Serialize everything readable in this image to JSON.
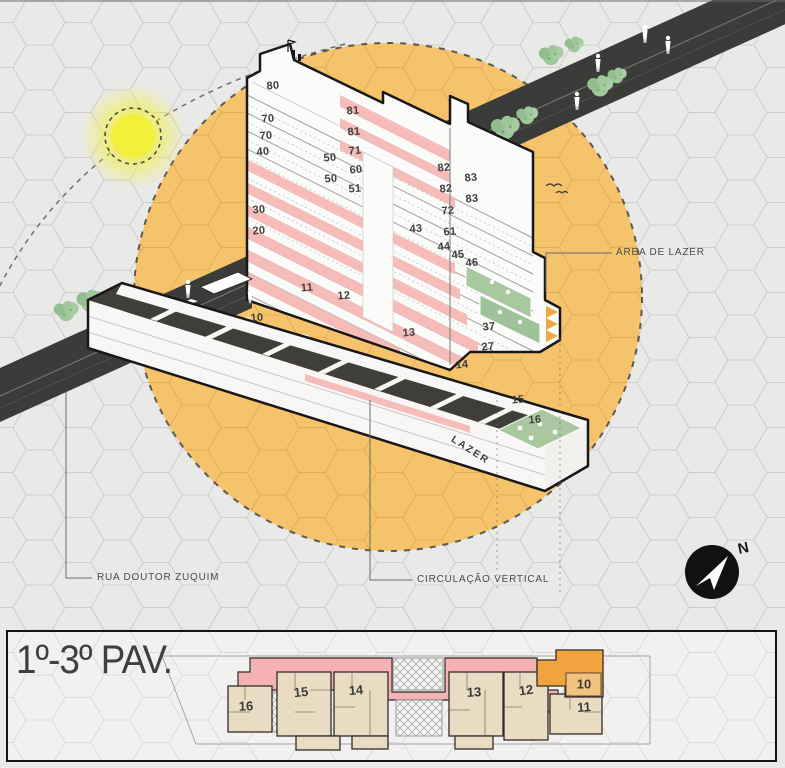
{
  "colors": {
    "circle_orange": "#f5c36c",
    "sun_yellow": "#f1ef39",
    "balcony_pink": "#f5bcba",
    "road_dark": "#3b3b39",
    "leisure_green": "#a9c8a0",
    "plan_beige": "#eadcc3",
    "highlight_unit": "#f1a43e",
    "ink": "#3e3e3c"
  },
  "annotations": {
    "area_lazer": "ÁREA DE LAZER",
    "rua": "RUA DOUTOR ZUQUIM",
    "circulacao": "CIRCULAÇÃO VERTICAL",
    "lazer_text": "LAZER",
    "north": "N"
  },
  "panel": {
    "floor_label": "1º-3º PAV."
  },
  "icons": {
    "sun": "sun-glow-disc",
    "north_arrow": "compass-needle-circle",
    "tree": "street-tree-cluster",
    "person": "pedestrian-silhouette"
  },
  "axon_units": [
    {
      "label": "80",
      "x": 273,
      "y": 86,
      "rot": -5
    },
    {
      "label": "70",
      "x": 268,
      "y": 119,
      "rot": -5
    },
    {
      "label": "70",
      "x": 266,
      "y": 136,
      "rot": -5
    },
    {
      "label": "40",
      "x": 263,
      "y": 152,
      "rot": -5
    },
    {
      "label": "30",
      "x": 259,
      "y": 210,
      "rot": -5
    },
    {
      "label": "20",
      "x": 259,
      "y": 231,
      "rot": -5
    },
    {
      "label": "81",
      "x": 353,
      "y": 111,
      "rot": -5
    },
    {
      "label": "81",
      "x": 354,
      "y": 132,
      "rot": -5
    },
    {
      "label": "71",
      "x": 355,
      "y": 151,
      "rot": -5
    },
    {
      "label": "50",
      "x": 330,
      "y": 158,
      "rot": -5
    },
    {
      "label": "60",
      "x": 356,
      "y": 170,
      "rot": -5
    },
    {
      "label": "50",
      "x": 331,
      "y": 179,
      "rot": -5
    },
    {
      "label": "51",
      "x": 355,
      "y": 189,
      "rot": -5
    },
    {
      "label": "82",
      "x": 444,
      "y": 168,
      "rot": -5
    },
    {
      "label": "83",
      "x": 471,
      "y": 178,
      "rot": -5
    },
    {
      "label": "82",
      "x": 446,
      "y": 189,
      "rot": -5
    },
    {
      "label": "83",
      "x": 472,
      "y": 199,
      "rot": -5
    },
    {
      "label": "72",
      "x": 448,
      "y": 211,
      "rot": -5
    },
    {
      "label": "61",
      "x": 450,
      "y": 232,
      "rot": -5
    },
    {
      "label": "43",
      "x": 416,
      "y": 229,
      "rot": -5
    },
    {
      "label": "44",
      "x": 444,
      "y": 247,
      "rot": -5
    },
    {
      "label": "45",
      "x": 458,
      "y": 255,
      "rot": -5
    },
    {
      "label": "46",
      "x": 472,
      "y": 263,
      "rot": -5
    },
    {
      "label": "37",
      "x": 489,
      "y": 327,
      "rot": -5
    },
    {
      "label": "27",
      "x": 488,
      "y": 347,
      "rot": -5
    },
    {
      "label": "10",
      "x": 257,
      "y": 318,
      "rot": -5
    },
    {
      "label": "11",
      "x": 307,
      "y": 288,
      "rot": -5
    },
    {
      "label": "12",
      "x": 344,
      "y": 296,
      "rot": -5
    },
    {
      "label": "13",
      "x": 409,
      "y": 333,
      "rot": -5
    },
    {
      "label": "14",
      "x": 462,
      "y": 365,
      "rot": -5
    },
    {
      "label": "15",
      "x": 518,
      "y": 400,
      "rot": -5
    },
    {
      "label": "16",
      "x": 535,
      "y": 420,
      "rot": -5
    }
  ],
  "plan_units": [
    {
      "label": "16",
      "x": 246,
      "y": 706,
      "rot": -2
    },
    {
      "label": "15",
      "x": 301,
      "y": 692,
      "rot": -6
    },
    {
      "label": "14",
      "x": 356,
      "y": 690,
      "rot": -4
    },
    {
      "label": "13",
      "x": 474,
      "y": 692,
      "rot": -3
    },
    {
      "label": "12",
      "x": 526,
      "y": 690,
      "rot": -8
    },
    {
      "label": "11",
      "x": 584,
      "y": 707,
      "rot": -4
    },
    {
      "label": "10",
      "x": 584,
      "y": 684,
      "rot": 0
    }
  ]
}
